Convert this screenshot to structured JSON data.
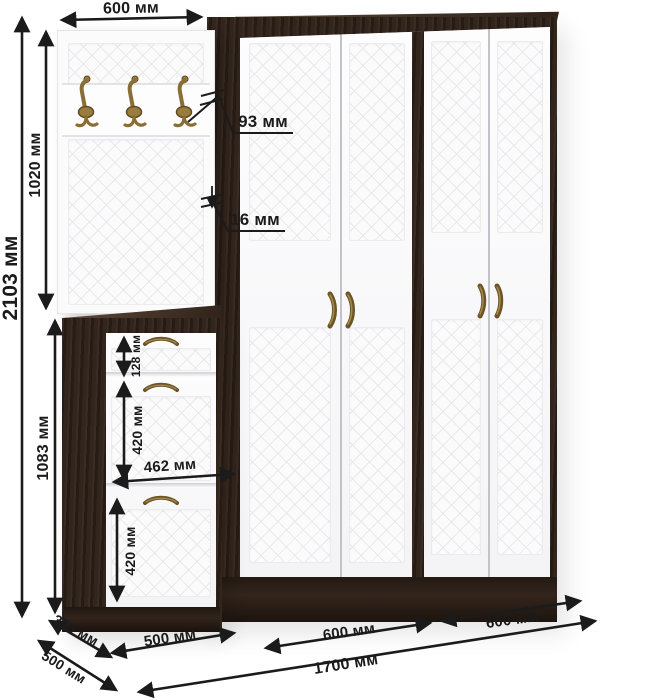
{
  "diagram": {
    "type": "furniture-dimension-diagram",
    "pieces": [
      "coat-hook-panel",
      "two-section-wardrobe",
      "shoe-cabinet"
    ],
    "hook_count": 3,
    "units": "мм"
  },
  "dims": {
    "panel_width": "600 мм",
    "total_height": "2103 мм",
    "panel_height": "1020 мм",
    "cabinet_height": "1083 мм",
    "hook_offset": "93 мм",
    "panel_thickness": "16 мм",
    "drawer_height": "128 мм",
    "flap1_height": "420 мм",
    "front_width": "462 мм",
    "flap2_height": "420 мм",
    "cabinet_depth": "350 мм",
    "wardrobe_depth": "500 мм",
    "cabinet_width": "500 мм",
    "section1_width": "600 мм",
    "section2_width": "600 мм",
    "total_width": "1700 мм"
  },
  "colors": {
    "background": "#ffffff",
    "wenge_dark": "#2e2118",
    "wenge_light": "#5e4a3a",
    "door_white": "#fbfbfc",
    "quilt_line": "#e9e9ed",
    "brass": "#8a6f35",
    "dimension_ink": "#1b1b1b"
  }
}
